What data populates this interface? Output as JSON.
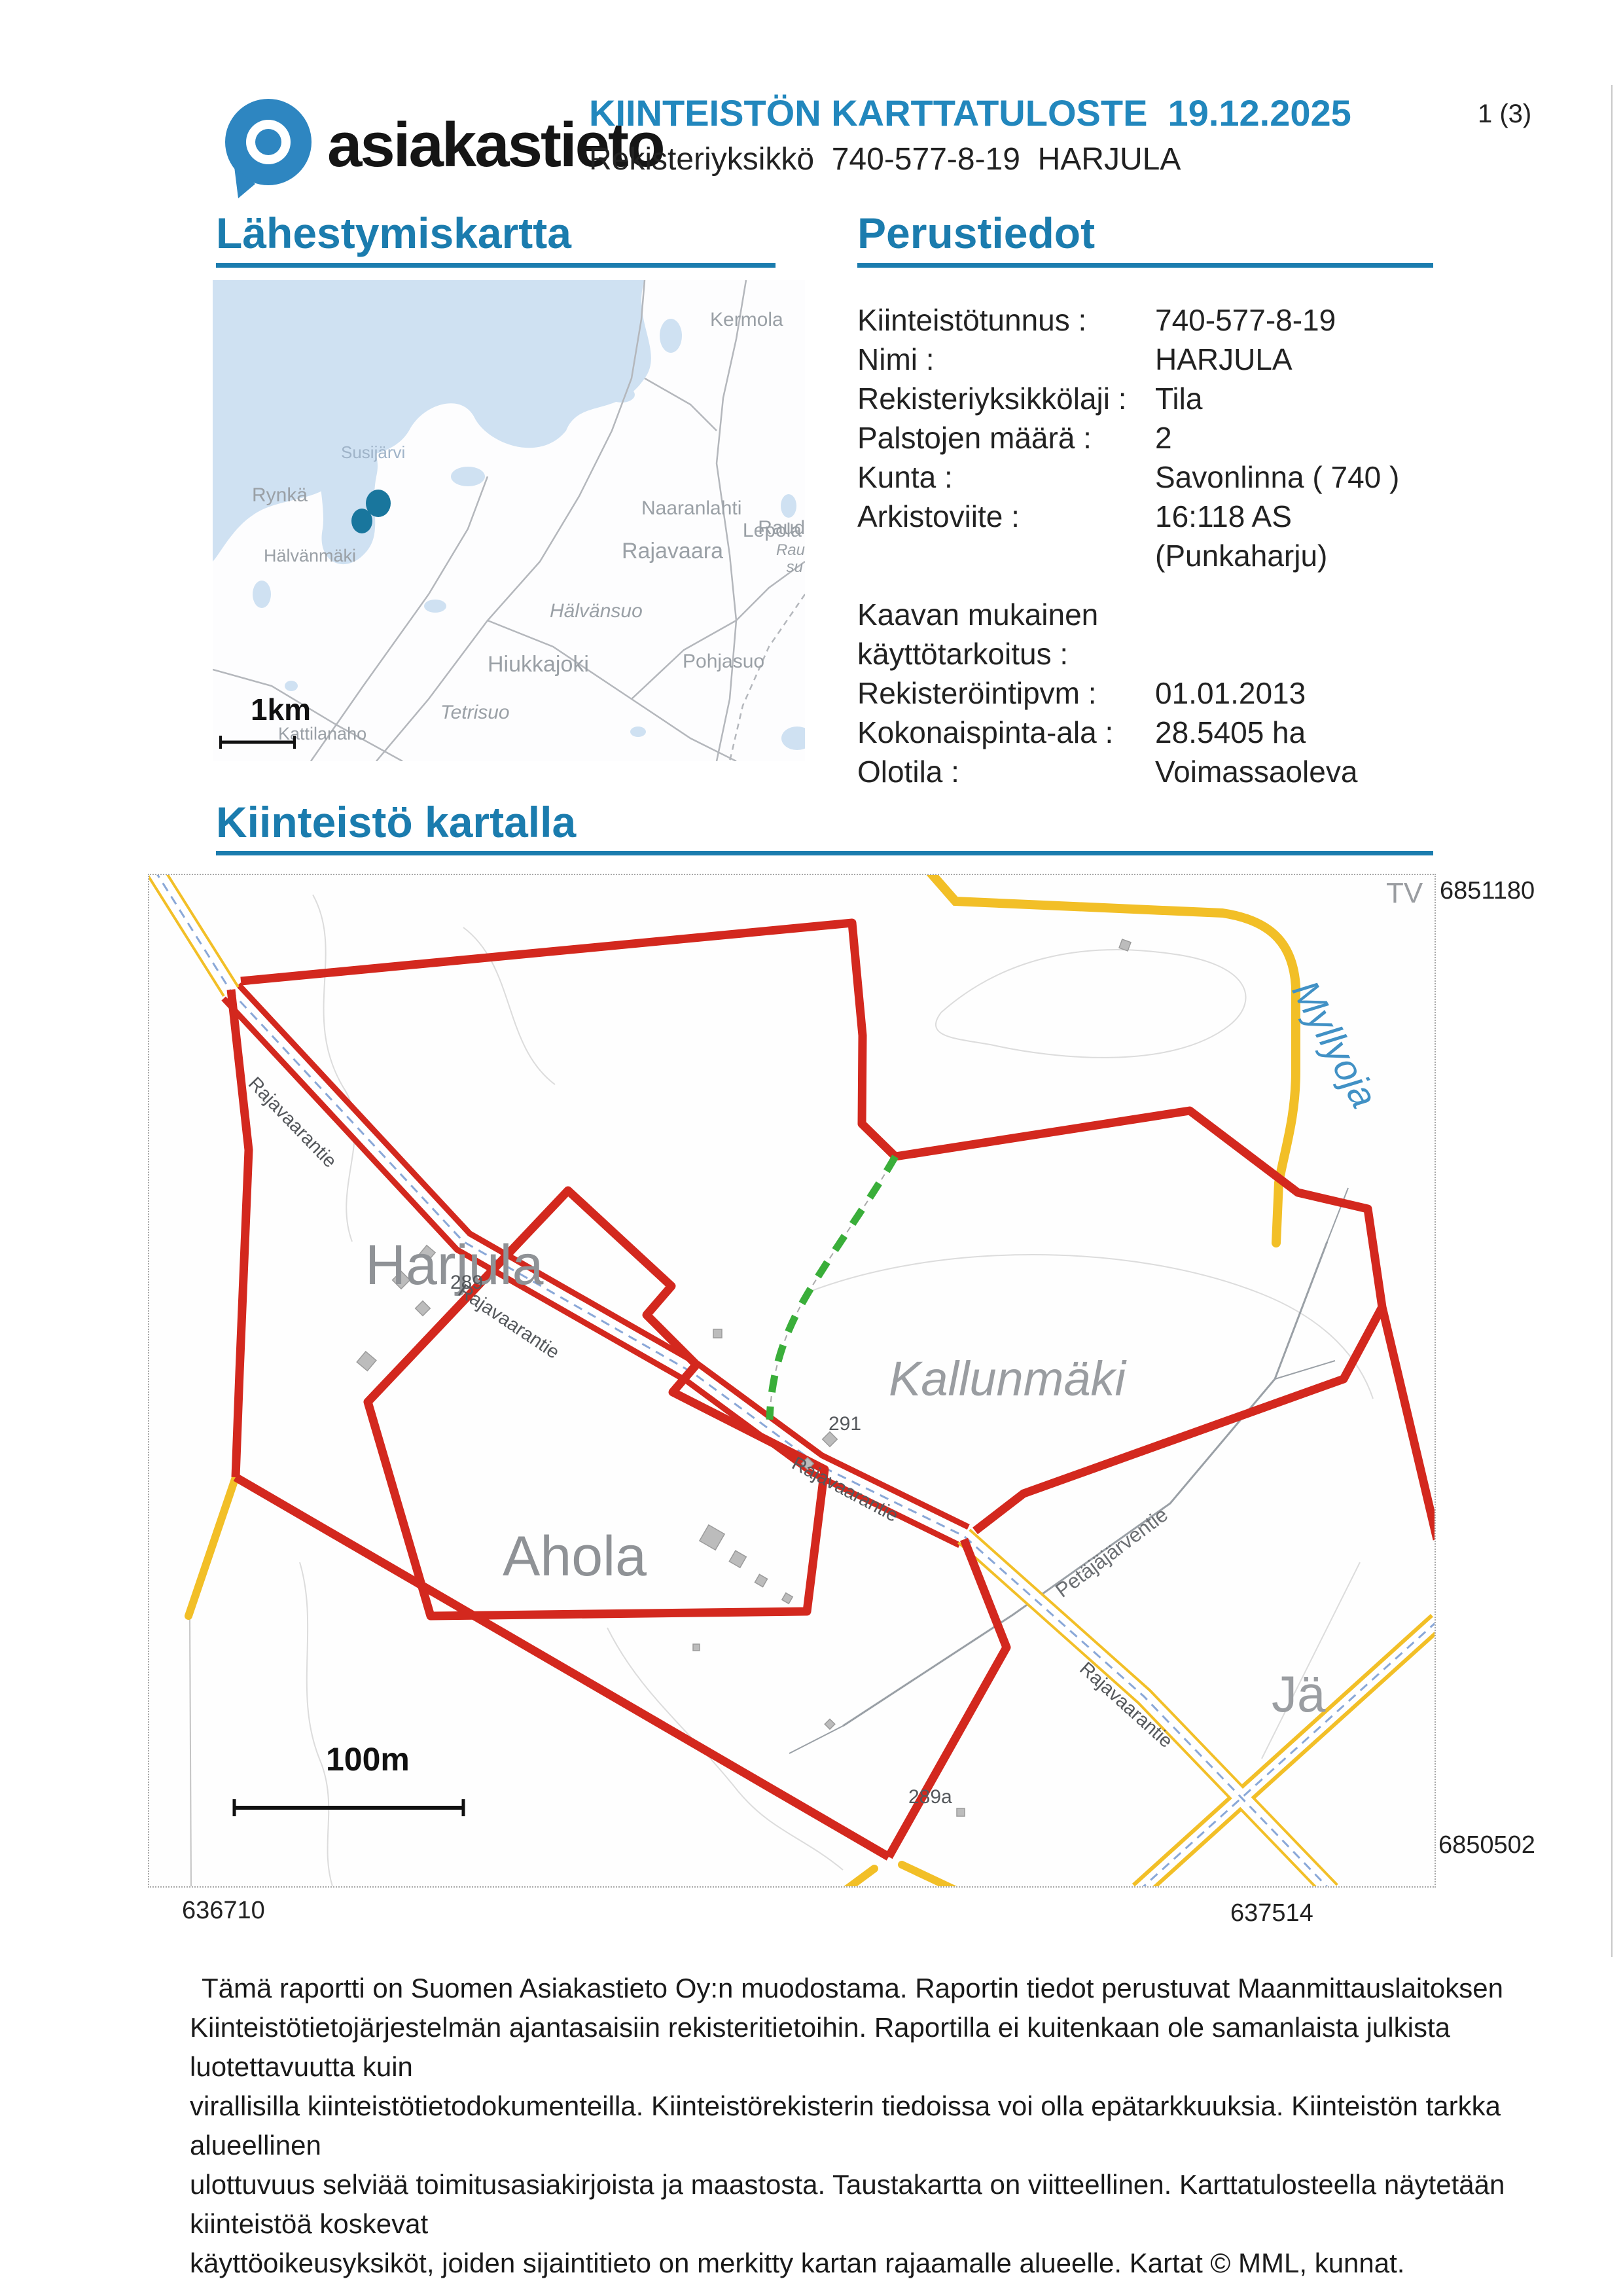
{
  "header": {
    "logo_text": "asiakastieto",
    "title": "KIINTEISTÖN KARTTATULOSTE  19.12.2025",
    "subtitle": "Rekisteriyksikkö  740-577-8-19  HARJULA",
    "page_indicator": "1 (3)"
  },
  "sections": {
    "approach_map_title": "Lähestymiskartta",
    "basic_info_title": "Perustiedot",
    "property_map_title": "Kiinteistö kartalla"
  },
  "basic_info": {
    "rows": [
      {
        "label": "Kiinteistötunnus :",
        "value": "740-577-8-19"
      },
      {
        "label": "Nimi :",
        "value": "HARJULA"
      },
      {
        "label": "Rekisteriyksikkölaji :",
        "value": "Tila"
      },
      {
        "label": "Palstojen määrä :",
        "value": "2"
      },
      {
        "label": "Kunta :",
        "value": "Savonlinna  ( 740 )"
      },
      {
        "label": "Arkistoviite :",
        "value": "16:118 AS"
      },
      {
        "label": "",
        "value": "(Punkaharju)"
      },
      {
        "label": "Kaavan mukainen",
        "value": ""
      },
      {
        "label": "käyttötarkoitus :",
        "value": ""
      },
      {
        "label": "Rekisteröintipvm :",
        "value": "01.01.2013"
      },
      {
        "label": "Kokonaispinta-ala :",
        "value": "28.5405 ha"
      },
      {
        "label": "Olotila :",
        "value": "Voimassaoleva"
      }
    ]
  },
  "approach_map": {
    "scale_label": "1km",
    "labels": {
      "kermola": "Kermola",
      "susijarvi": "Susijärvi",
      "rynka": "Rynkä",
      "halvansuo": "Hälvänsuo",
      "naaranlahti": "Naaranlahti",
      "lepola": "Lepola",
      "hiukkajoki": "Hiukkajoki",
      "raud": "Raud",
      "rau": "Rau",
      "su": "su",
      "rajavaara": "Rajavaara",
      "halvanmaki": "Hälvänmäki",
      "pohjasuo": "Pohjasuo",
      "tetrisuo": "Tetrisuo",
      "kattilanaho": "Kattilanaho"
    }
  },
  "property_map": {
    "scale_label": "100m",
    "edge_text": "TV",
    "coords": {
      "top_right": "6851180",
      "bottom_right": "6850502",
      "bottom_left": "636710",
      "bottom_mid": "637514"
    },
    "labels": {
      "harjula": "Harjula",
      "ahola": "Ahola",
      "kallunmaki": "Kallunmäki",
      "ja_partial": "Jä",
      "myllyoja": "Myllyoja",
      "rajavaarantie": "Rajavaarantie",
      "petajajarventie": "Petäjäjärventie",
      "num_289": "289",
      "num_291": "291",
      "num_289a": "289a"
    }
  },
  "footer": {
    "lines": [
      "Tämä raportti on Suomen Asiakastieto Oy:n muodostama. Raportin tiedot perustuvat Maanmittauslaitoksen",
      "Kiinteistötietojärjestelmän ajantasaisiin rekisteritietoihin. Raportilla ei kuitenkaan ole samanlaista julkista luotettavuutta kuin",
      "virallisilla kiinteistötietodokumenteilla. Kiinteistörekisterin tiedoissa voi olla epätarkkuuksia. Kiinteistön tarkka alueellinen",
      "ulottuvuus selviää toimitusasiakirjoista ja maastosta. Taustakartta on viitteellinen. Karttatulosteella näytetään kiinteistöä koskevat",
      "käyttöoikeusyksiköt, joiden sijaintitieto on merkitty kartan rajaamalle alueelle. Kartat © MML, kunnat."
    ]
  },
  "colors": {
    "heading_blue": "#1b7cae",
    "title_blue": "#2287bd",
    "boundary_red": "#d3281e",
    "road_yellow": "#f2bf27",
    "path_green": "#3aae3a",
    "water_blue": "#cfe1f2",
    "label_gray": "#8f9296",
    "marker_teal": "#19769d"
  }
}
